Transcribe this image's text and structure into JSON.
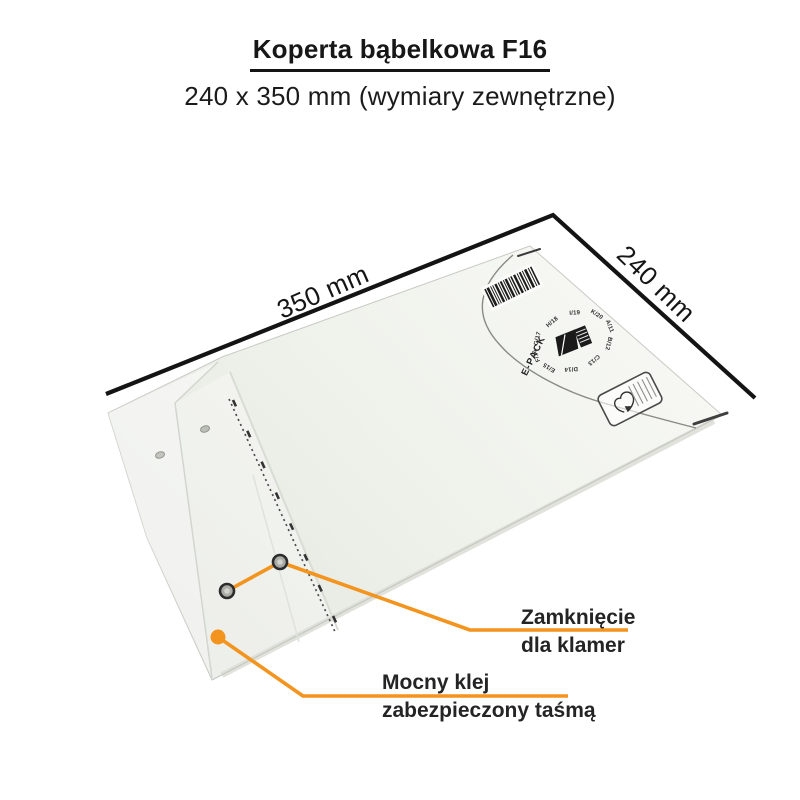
{
  "header": {
    "title": "Koperta bąbelkowa F16",
    "subtitle": "240 x 350 mm (wymiary zewnętrzne)"
  },
  "dimensions": {
    "width_label": "350 mm",
    "height_label": "240 mm"
  },
  "annotations": {
    "clasp": {
      "line1": "Zamknięcie",
      "line2": "dla klamer"
    },
    "glue": {
      "line1": "Mocny klej",
      "line2": "zabezpieczony taśmą"
    }
  },
  "envelope": {
    "brand": "E-PACK",
    "size_codes": [
      "A/11",
      "B/12",
      "C/13",
      "D/14",
      "E/15",
      "F/16",
      "G/17",
      "H/18",
      "I/19",
      "K/20"
    ],
    "colors": {
      "accent_orange": "#F2941E",
      "dimension_line": "#141414",
      "paper_light": "#F7F8F4",
      "paper_shade": "#E6E8E2"
    }
  }
}
